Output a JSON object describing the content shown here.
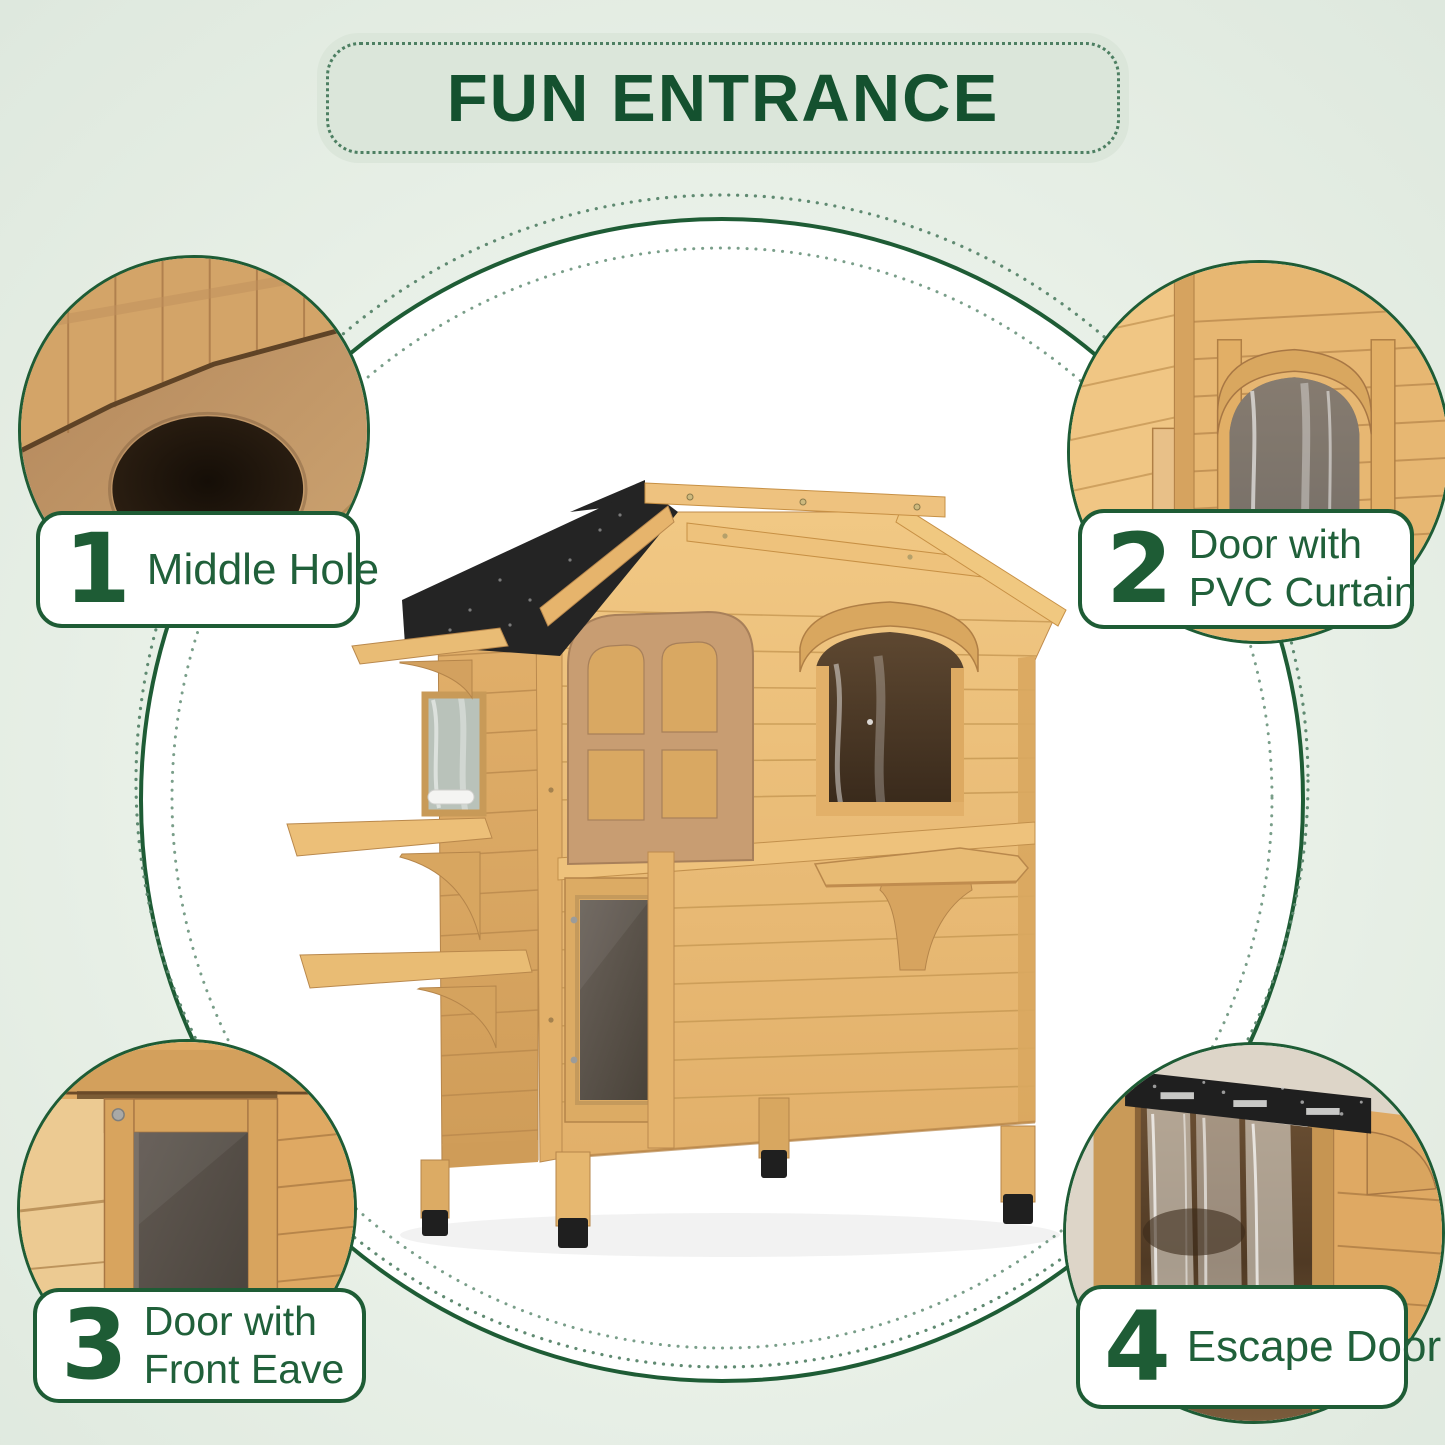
{
  "banner": {
    "title": "FUN ENTRANCE"
  },
  "features": [
    {
      "number": "1",
      "line1": "Middle Hole",
      "line2": "",
      "photo": "interior-floor-middle-hole"
    },
    {
      "number": "2",
      "line1": "Door with",
      "line2": "PVC Curtain",
      "photo": "arched-door-with-pvc-curtain"
    },
    {
      "number": "3",
      "line1": "Door with",
      "line2": "Front Eave",
      "photo": "flap-door-with-front-eave"
    },
    {
      "number": "4",
      "line1": "Escape Door",
      "line2": "",
      "photo": "escape-door-with-pvc-strips"
    }
  ],
  "product": {
    "subject": "two-story wooden cat house"
  },
  "colors": {
    "accent_green": "#1e5c35",
    "title_green": "#14512f",
    "dot_green": "#5f8a71",
    "background": "#ebf2ea",
    "banner_fill": "#dbe6da",
    "circle_fill": "#ffffff",
    "wood_light": "#ecc17c",
    "wood_mid": "#d9a75f",
    "roof_black": "#242424"
  }
}
